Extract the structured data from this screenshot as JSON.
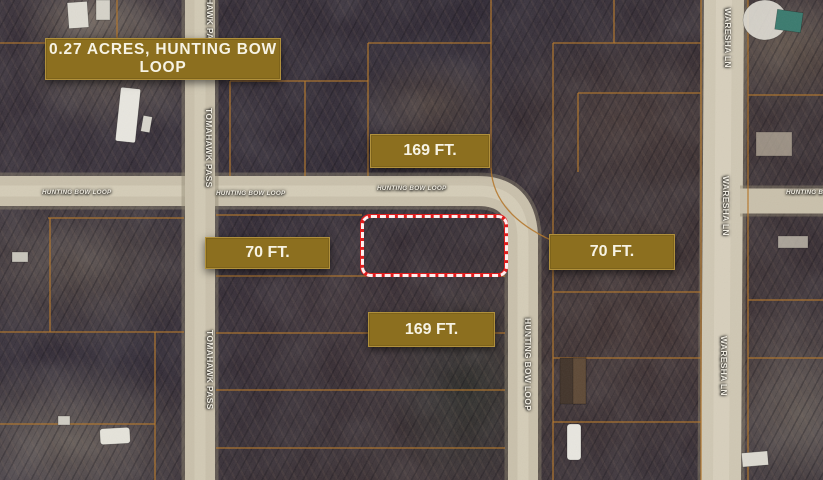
{
  "title": {
    "label": "0.27 ACRES, HUNTING BOW LOOP"
  },
  "measurements": {
    "top": "169 FT.",
    "bottom": "169 FT.",
    "left": "70 FT.",
    "right": "70 FT."
  },
  "streets": {
    "hunting_bow_loop": "HUNTING BOW LOOP",
    "tomahawk_pass": "TOMAHAWK PASS",
    "waresha_ln": "WARESHA LN"
  },
  "colors": {
    "label_gold": "#8c6f1f",
    "label_border": "#b0903c",
    "label_text": "#f7f3e4",
    "parcel_line": "#b5772a",
    "highlight_red": "#df1d1d",
    "road_tan": "#c9c0ab"
  }
}
